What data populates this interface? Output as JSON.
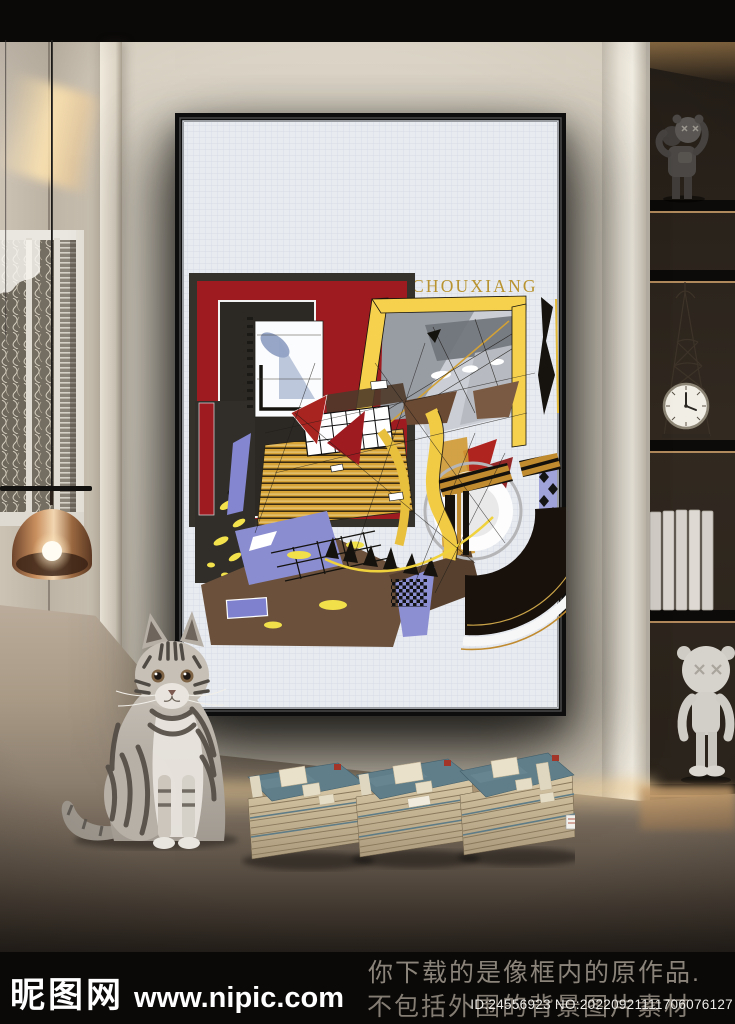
{
  "artwork": {
    "title": "CHOUXIANG",
    "palette": {
      "canvas": "#e8ebf0",
      "frame": "#0d0d0d",
      "red": "#9e1b20",
      "charcoal": "#2c2925",
      "yellow": "#f5d14d",
      "gold": "#c08a2e",
      "ochre": "#d8a437",
      "periwinkle": "#8b8dd1",
      "brown": "#6b513c",
      "title_gold": "#b8932f"
    }
  },
  "scene": {
    "objects": [
      "tabby-cat",
      "antique-book-stacks",
      "kaws-style-figure-dark",
      "tower-clock",
      "white-books",
      "kaws-style-figure-white",
      "pendant-lamp",
      "lattice-window"
    ]
  },
  "watermark": {
    "site_name": "昵图网",
    "site_url": "www.nipic.com",
    "notice_line1": "你下载的是像框内的原作品.",
    "notice_line2": "不包括外围的背景图片素材",
    "id_text": "ID:24556923 NO:20220921111706076127"
  }
}
